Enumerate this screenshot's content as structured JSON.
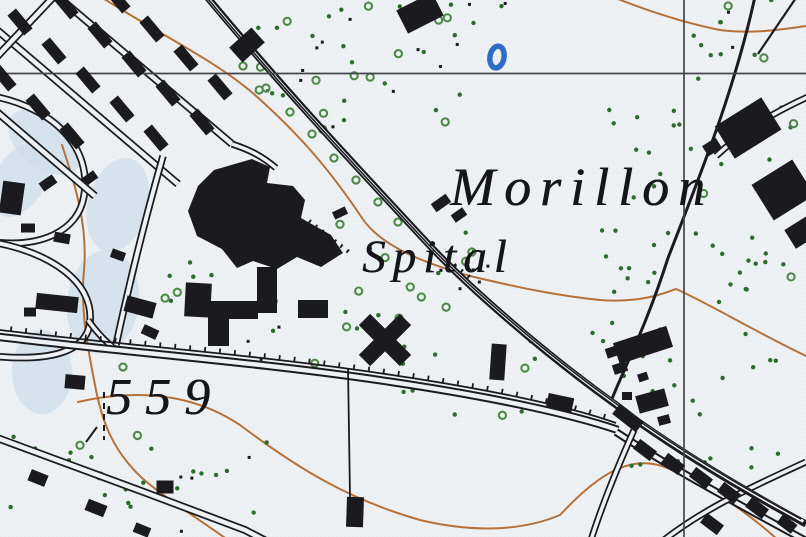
{
  "figure": {
    "width": 806,
    "height": 537
  },
  "map": {
    "colors": {
      "paper": "#eef1f4",
      "halftone": "#dfe3e8",
      "ink": "#1b1b1f",
      "contour": "#b5713a",
      "green_dot": "#2e6b2e",
      "green_ring": "#4f8a4b",
      "water_blue": "#2f6cc4",
      "wash_blue": "#cfdde9",
      "grid": "#45454e"
    },
    "labels": {
      "morillon": {
        "text": "Morillon",
        "x": 450,
        "y": 160,
        "size": 54,
        "spacing": 9
      },
      "spital": {
        "text": "Spital",
        "x": 362,
        "y": 234,
        "size": 47,
        "spacing": 7
      },
      "elev559": {
        "text": "559",
        "x": 106,
        "y": 372,
        "size": 52,
        "spacing": 13
      }
    },
    "grid": {
      "horizontal_y": 73.5,
      "vertical_x": 684,
      "stroke_width": 1.7
    },
    "contours": [
      {
        "d": "M98,-5 C160,35 215,60 255,95 C300,135 330,170 362,218 C380,245 420,262 470,276 C520,288 560,296 600,300 C640,303 662,294 676,289 C706,302 752,330 806,356"
      },
      {
        "d": "M608,-5 C640,8 680,22 720,30 C750,34 780,30 806,26"
      },
      {
        "d": "M78,402 C140,388 195,395 240,425 C300,470 350,500 420,520 C470,532 520,532 560,515 C600,472 630,456 662,466 C700,480 745,510 778,540"
      },
      {
        "d": "M62,145 C75,185 88,225 84,270 C80,310 88,350 96,390 C102,420 112,450 142,478 C165,498 200,520 228,540"
      }
    ],
    "washes": [
      {
        "cx": 45,
        "cy": 142,
        "rx": 42,
        "ry": 26,
        "rot": 38
      },
      {
        "cx": 118,
        "cy": 205,
        "rx": 30,
        "ry": 48,
        "rot": 15
      },
      {
        "cx": 103,
        "cy": 302,
        "rx": 36,
        "ry": 52,
        "rot": 8
      },
      {
        "cx": 42,
        "cy": 372,
        "rx": 30,
        "ry": 42,
        "rot": 0
      },
      {
        "cx": 20,
        "cy": 180,
        "rx": 25,
        "ry": 40,
        "rot": 30
      }
    ],
    "roads": [
      {
        "d": "M-8,96 C55,108 92,148 84,196 C78,232 40,248 -8,242",
        "outer": 7.5,
        "inner": 4
      },
      {
        "d": "M-8,242 C50,252 94,282 90,322 C87,352 50,362 -8,356",
        "outer": 7.5,
        "inner": 4
      },
      {
        "d": "M88,320 C98,334 106,342 114,348",
        "outer": 7,
        "inner": 3.5
      },
      {
        "d": "M-10,24 L178,184",
        "outer": 8,
        "inner": 4.5
      },
      {
        "d": "M50,-10 L232,144",
        "outer": 8,
        "inner": 4.5
      },
      {
        "d": "M-10,106 L95,196",
        "outer": 8,
        "inner": 4.5
      },
      {
        "d": "M60,-10 L-10,64",
        "outer": 8,
        "inner": 4.5
      },
      {
        "d": "M232,144 C250,150 262,156 276,168",
        "outer": 7,
        "inner": 3.5
      },
      {
        "d": "M163,156 C146,216 130,280 116,345",
        "outer": 7.5,
        "inner": 4
      },
      {
        "d": "M-8,436 C80,468 160,498 245,530 L268,542",
        "outer": 8,
        "inner": 4.5
      },
      {
        "d": "M-8,336 C120,352 260,362 392,382 C480,395 565,412 618,430",
        "outer": 8.5,
        "inner": 4.5
      },
      {
        "d": "M616,432 C680,474 748,509 808,542",
        "outer": 8,
        "inner": 4
      },
      {
        "d": "M634,430 C618,466 603,502 591,540",
        "outer": 7,
        "inner": 3.5
      },
      {
        "d": "M664,540 C700,512 740,492 806,462",
        "outer": 7,
        "inner": 3.5
      },
      {
        "d": "M810,96 C770,114 742,132 716,156",
        "outer": 7,
        "inner": 3.5
      },
      {
        "d": "M756,-8 C735,90 700,175 668,258 C645,330 622,372 610,404",
        "outer": 3,
        "inner": 0
      },
      {
        "d": "M800,-8 L758,54",
        "outer": 2.2,
        "inner": 0
      },
      {
        "d": "M348,368 L350,497",
        "outer": 1.8,
        "inner": 0
      },
      {
        "d": "M203,-8 C280,85 350,160 432,248 C470,288 540,350 612,402 C622,409 630,416 640,423 C700,465 760,499 806,524",
        "outer": 7,
        "inner": 0,
        "extra": [
          {
            "dx": -2.6,
            "dy": -2.6,
            "c": "paper",
            "w": 3
          },
          {
            "dx": -4.8,
            "dy": -4.8,
            "c": "ink",
            "w": 1.5
          }
        ]
      }
    ],
    "tramway": {
      "d": "M-8,329 C120,345 262,355 392,375 C480,388 566,405 616,423",
      "tick_spacing": 15,
      "tick_len": 5,
      "stroke_width": 1.8
    },
    "fences": [
      {
        "d": "M104,392 L104,440",
        "dash": "6 5",
        "w": 2
      },
      {
        "d": "M86,442 L97,427",
        "dash": "",
        "w": 2
      },
      {
        "d": "M309,221 L349,252",
        "dash": "2 6",
        "w": 4
      },
      {
        "d": "M447,259 L473,280",
        "dash": "2 7",
        "w": 4
      }
    ],
    "polygons": [
      {
        "points": "214,170 252,159 270,167 267,183 293,186 305,200 301,218 331,235 343,253 321,267 297,257 277,269 253,261 237,268 222,249 197,236 188,211 198,186"
      },
      {
        "points": "208,301 258,301 258,319 229,319 229,346 208,346"
      }
    ],
    "buildings": [
      {
        "x": 20,
        "y": 22,
        "w": 26,
        "h": 11,
        "r": 50
      },
      {
        "x": 54,
        "y": 51,
        "w": 26,
        "h": 11,
        "r": 50
      },
      {
        "x": 88,
        "y": 80,
        "w": 26,
        "h": 11,
        "r": 50
      },
      {
        "x": 122,
        "y": 109,
        "w": 26,
        "h": 11,
        "r": 50
      },
      {
        "x": 156,
        "y": 138,
        "w": 26,
        "h": 11,
        "r": 50
      },
      {
        "x": 66,
        "y": 6,
        "w": 26,
        "h": 11,
        "r": 50
      },
      {
        "x": 100,
        "y": 35,
        "w": 26,
        "h": 11,
        "r": 50
      },
      {
        "x": 134,
        "y": 64,
        "w": 26,
        "h": 11,
        "r": 50
      },
      {
        "x": 168,
        "y": 93,
        "w": 26,
        "h": 11,
        "r": 50
      },
      {
        "x": 202,
        "y": 122,
        "w": 26,
        "h": 11,
        "r": 50
      },
      {
        "x": 118,
        "y": 0,
        "w": 26,
        "h": 11,
        "r": 50
      },
      {
        "x": 152,
        "y": 29,
        "w": 26,
        "h": 11,
        "r": 50
      },
      {
        "x": 186,
        "y": 58,
        "w": 26,
        "h": 11,
        "r": 50
      },
      {
        "x": 220,
        "y": 87,
        "w": 26,
        "h": 11,
        "r": 50
      },
      {
        "x": 4,
        "y": 78,
        "w": 26,
        "h": 11,
        "r": 50
      },
      {
        "x": 38,
        "y": 107,
        "w": 26,
        "h": 11,
        "r": 50
      },
      {
        "x": 72,
        "y": 136,
        "w": 26,
        "h": 11,
        "r": 50
      },
      {
        "x": 12,
        "y": 198,
        "w": 22,
        "h": 32,
        "r": 8
      },
      {
        "x": 48,
        "y": 183,
        "w": 16,
        "h": 10,
        "r": -35
      },
      {
        "x": 90,
        "y": 178,
        "w": 14,
        "h": 9,
        "r": -35
      },
      {
        "x": 28,
        "y": 228,
        "w": 14,
        "h": 9,
        "r": 0
      },
      {
        "x": 62,
        "y": 238,
        "w": 16,
        "h": 10,
        "r": 10
      },
      {
        "x": 118,
        "y": 255,
        "w": 14,
        "h": 9,
        "r": 20
      },
      {
        "x": 140,
        "y": 307,
        "w": 30,
        "h": 16,
        "r": 15
      },
      {
        "x": 150,
        "y": 332,
        "w": 16,
        "h": 10,
        "r": 25
      },
      {
        "x": 30,
        "y": 312,
        "w": 12,
        "h": 9,
        "r": 0
      },
      {
        "x": 247,
        "y": 45,
        "w": 30,
        "h": 20,
        "r": -42
      },
      {
        "x": 420,
        "y": 13,
        "w": 40,
        "h": 26,
        "r": -27
      },
      {
        "x": 267,
        "y": 290,
        "w": 20,
        "h": 46,
        "r": 0
      },
      {
        "x": 313,
        "y": 309,
        "w": 30,
        "h": 18,
        "r": 0
      },
      {
        "x": 385,
        "y": 340,
        "w": 58,
        "h": 16,
        "r": 45
      },
      {
        "x": 385,
        "y": 340,
        "w": 58,
        "h": 16,
        "r": -45
      },
      {
        "x": 340,
        "y": 213,
        "w": 14,
        "h": 8,
        "r": -25
      },
      {
        "x": 441,
        "y": 203,
        "w": 18,
        "h": 10,
        "r": -35
      },
      {
        "x": 459,
        "y": 215,
        "w": 14,
        "h": 9,
        "r": -35
      },
      {
        "x": 498,
        "y": 362,
        "w": 15,
        "h": 36,
        "r": 4
      },
      {
        "x": 560,
        "y": 403,
        "w": 26,
        "h": 15,
        "r": 12
      },
      {
        "x": 652,
        "y": 401,
        "w": 30,
        "h": 18,
        "r": -15
      },
      {
        "x": 627,
        "y": 396,
        "w": 10,
        "h": 8,
        "r": 0
      },
      {
        "x": 664,
        "y": 420,
        "w": 12,
        "h": 9,
        "r": -15
      },
      {
        "x": 643,
        "y": 345,
        "w": 56,
        "h": 22,
        "r": -18
      },
      {
        "x": 612,
        "y": 352,
        "w": 12,
        "h": 10,
        "r": -18
      },
      {
        "x": 620,
        "y": 368,
        "w": 14,
        "h": 10,
        "r": -18
      },
      {
        "x": 643,
        "y": 377,
        "w": 10,
        "h": 8,
        "r": -18
      },
      {
        "x": 748,
        "y": 128,
        "w": 55,
        "h": 38,
        "r": -32
      },
      {
        "x": 783,
        "y": 190,
        "w": 48,
        "h": 42,
        "r": -32
      },
      {
        "x": 712,
        "y": 147,
        "w": 16,
        "h": 12,
        "r": -32
      },
      {
        "x": 802,
        "y": 232,
        "w": 28,
        "h": 22,
        "r": -32
      },
      {
        "x": 645,
        "y": 450,
        "w": 21,
        "h": 12,
        "r": 37
      },
      {
        "x": 673,
        "y": 464,
        "w": 21,
        "h": 12,
        "r": 37
      },
      {
        "x": 701,
        "y": 478,
        "w": 21,
        "h": 12,
        "r": 37
      },
      {
        "x": 729,
        "y": 493,
        "w": 21,
        "h": 12,
        "r": 37
      },
      {
        "x": 757,
        "y": 508,
        "w": 21,
        "h": 12,
        "r": 37
      },
      {
        "x": 712,
        "y": 524,
        "w": 21,
        "h": 12,
        "r": 37
      },
      {
        "x": 787,
        "y": 524,
        "w": 18,
        "h": 11,
        "r": 37
      },
      {
        "x": 628,
        "y": 418,
        "w": 30,
        "h": 13,
        "r": 38
      },
      {
        "x": 75,
        "y": 382,
        "w": 20,
        "h": 14,
        "r": 5
      },
      {
        "x": 57,
        "y": 303,
        "w": 42,
        "h": 16,
        "r": 6
      },
      {
        "x": 198,
        "y": 300,
        "w": 26,
        "h": 34,
        "r": 3
      },
      {
        "x": 165,
        "y": 487,
        "w": 17,
        "h": 13,
        "r": 0
      },
      {
        "x": 355,
        "y": 512,
        "w": 17,
        "h": 30,
        "r": 2
      },
      {
        "x": 38,
        "y": 478,
        "w": 18,
        "h": 12,
        "r": 22
      },
      {
        "x": 96,
        "y": 508,
        "w": 20,
        "h": 12,
        "r": 22
      },
      {
        "x": 142,
        "y": 530,
        "w": 16,
        "h": 10,
        "r": 22
      }
    ],
    "veg_clusters": [
      {
        "box": [
          250,
          0,
          260,
          130
        ],
        "dots": 20,
        "rings": 13,
        "black": 13,
        "seed": 11
      },
      {
        "box": [
          600,
          95,
          200,
          210
        ],
        "dots": 44,
        "rings": 3,
        "black": 0,
        "seed": 22
      },
      {
        "box": [
          590,
          310,
          212,
          170
        ],
        "dots": 26,
        "rings": 0,
        "black": 0,
        "seed": 33
      },
      {
        "box": [
          332,
          222,
          150,
          98
        ],
        "dots": 5,
        "rings": 9,
        "black": 0,
        "seed": 44
      },
      {
        "box": [
          0,
          434,
          268,
          98
        ],
        "dots": 20,
        "rings": 3,
        "black": 4,
        "seed": 55
      },
      {
        "box": [
          388,
          332,
          180,
          85
        ],
        "dots": 11,
        "rings": 2,
        "black": 0,
        "seed": 66
      },
      {
        "box": [
          95,
          262,
          140,
          75
        ],
        "dots": 7,
        "rings": 2,
        "black": 0,
        "seed": 77
      },
      {
        "box": [
          690,
          0,
          112,
          85
        ],
        "dots": 9,
        "rings": 2,
        "black": 2,
        "seed": 88
      },
      {
        "box": [
          440,
          250,
          55,
          60
        ],
        "dots": 0,
        "rings": 0,
        "black": 6,
        "seed": 99
      },
      {
        "box": [
          240,
          300,
          120,
          70
        ],
        "dots": 4,
        "rings": 3,
        "black": 4,
        "seed": 101
      }
    ],
    "tree_rings": [
      [
        243,
        66
      ],
      [
        266,
        88
      ],
      [
        290,
        112
      ],
      [
        312,
        134
      ],
      [
        334,
        158
      ],
      [
        356,
        180
      ],
      [
        378,
        202
      ],
      [
        398,
        222
      ],
      [
        123,
        367
      ]
    ],
    "symbols": {
      "pond_oval": {
        "cx": 497,
        "cy": 57,
        "rx": 7,
        "ry": 11,
        "rot": 10,
        "stroke_width": 5.5
      }
    }
  }
}
